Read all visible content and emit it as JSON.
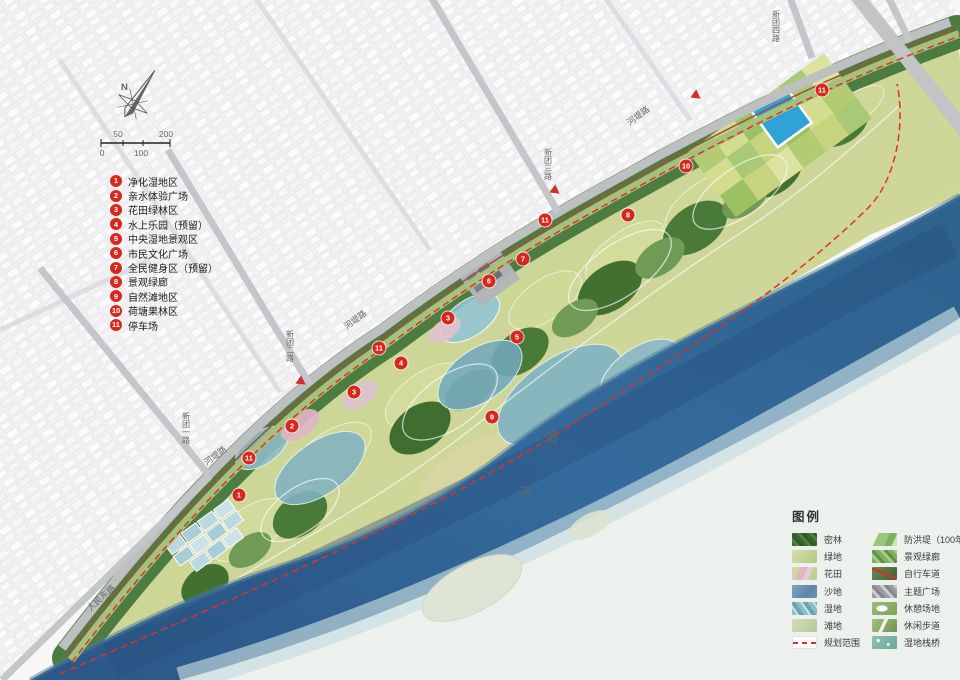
{
  "compass": {
    "north_label": "N"
  },
  "scale_bar": {
    "top_left": "50",
    "top_right": "200",
    "bottom_left": "0",
    "bottom_mid": "100"
  },
  "zones": [
    {
      "num": "1",
      "label": "净化湿地区"
    },
    {
      "num": "2",
      "label": "亲水体验广场"
    },
    {
      "num": "3",
      "label": "花田绿林区"
    },
    {
      "num": "4",
      "label": "水上乐园（预留）"
    },
    {
      "num": "5",
      "label": "中央湿地景观区"
    },
    {
      "num": "6",
      "label": "市民文化广场"
    },
    {
      "num": "7",
      "label": "全民健身区（预留）"
    },
    {
      "num": "8",
      "label": "景观绿廊"
    },
    {
      "num": "9",
      "label": "自然滩地区"
    },
    {
      "num": "10",
      "label": "荷塘果林区"
    },
    {
      "num": "11",
      "label": "停车场"
    }
  ],
  "map_legend": {
    "title": "图例",
    "left": [
      {
        "label": "密林"
      },
      {
        "label": "绿地"
      },
      {
        "label": "花田"
      },
      {
        "label": "沙地"
      },
      {
        "label": "湿地"
      },
      {
        "label": "滩地"
      },
      {
        "label": "规划范围"
      }
    ],
    "right": [
      {
        "label": "防洪堤（100年）"
      },
      {
        "label": "景观绿廊"
      },
      {
        "label": "自行车道"
      },
      {
        "label": "主题广场"
      },
      {
        "label": "休憩场地"
      },
      {
        "label": "休闲步道"
      },
      {
        "label": "湿地栈桥"
      }
    ]
  },
  "roads": {
    "hedi": "河堤路",
    "renmin_dong": "人民东路",
    "xintuan1": "新团一路",
    "xintuan2": "新团二路",
    "xintuan3": "新团三路",
    "xintuan4": "新团四路"
  },
  "river": {
    "name_char_1": "渭",
    "name_char_2": "河"
  },
  "markers": [
    {
      "num": "1",
      "x": 239,
      "y": 495
    },
    {
      "num": "2",
      "x": 292,
      "y": 426
    },
    {
      "num": "3",
      "x": 354,
      "y": 392
    },
    {
      "num": "3",
      "x": 448,
      "y": 318
    },
    {
      "num": "4",
      "x": 401,
      "y": 363
    },
    {
      "num": "5",
      "x": 517,
      "y": 337
    },
    {
      "num": "6",
      "x": 489,
      "y": 281
    },
    {
      "num": "7",
      "x": 523,
      "y": 259
    },
    {
      "num": "8",
      "x": 628,
      "y": 215
    },
    {
      "num": "9",
      "x": 492,
      "y": 417
    },
    {
      "num": "10",
      "x": 686,
      "y": 166
    },
    {
      "num": "11",
      "x": 379,
      "y": 348
    },
    {
      "num": "11",
      "x": 545,
      "y": 220
    },
    {
      "num": "11",
      "x": 249,
      "y": 458
    },
    {
      "num": "11",
      "x": 822,
      "y": 90
    }
  ],
  "colors": {
    "marker_red": "#d7281d",
    "boundary_red": "#e03128",
    "river_blue": "#2f5f8e",
    "forest_green": "#4a7a3f",
    "pond_blue": "#2fa3d8"
  }
}
